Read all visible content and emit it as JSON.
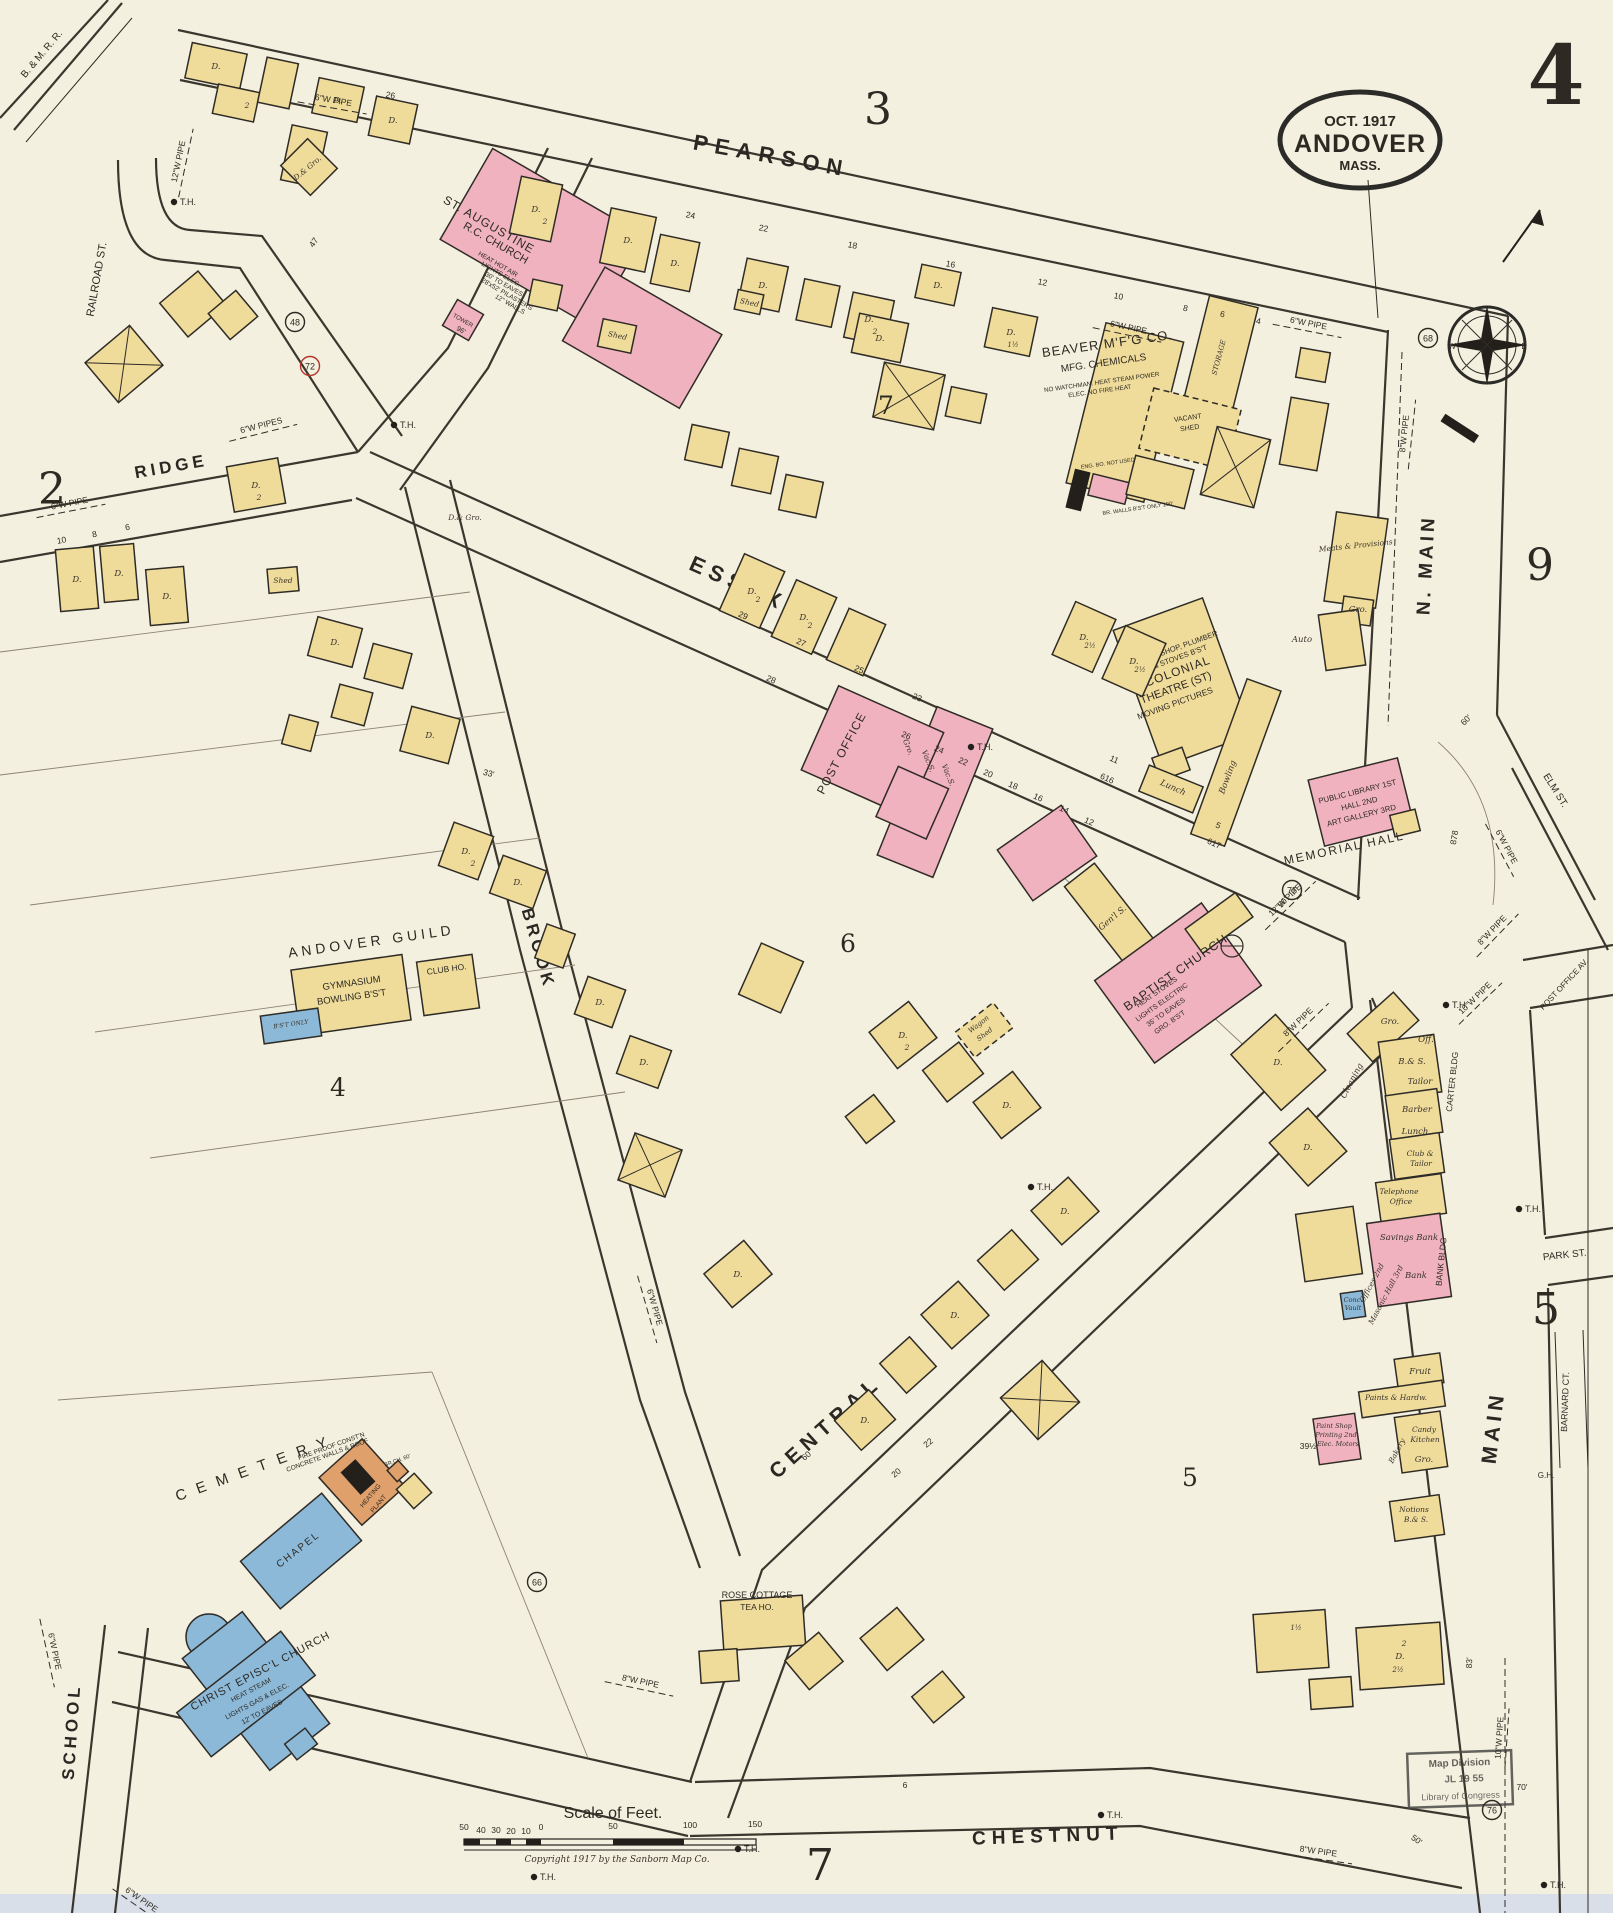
{
  "sheet": {
    "number": "4"
  },
  "stamp": {
    "date": "OCT. 1917",
    "city": "ANDOVER",
    "state": "MASS."
  },
  "adjacent": {
    "top": "3",
    "left": "2",
    "right": "9",
    "right_mid": "5",
    "bottom": "7"
  },
  "blocks": {
    "b7": "7",
    "b6": "6",
    "b4": "4",
    "b5": "5"
  },
  "streets": {
    "pearson": "PEARSON",
    "essex": "ESSEX",
    "ridge": "RIDGE",
    "brook": "BROOK",
    "central": "CENTRAL",
    "chestnut": "CHESTNUT",
    "school": "SCHOOL",
    "n_main": "N. MAIN",
    "main": "MAIN",
    "railroad": "RAILROAD ST.",
    "elm": "ELM ST.",
    "park": "PARK ST.",
    "barnard": "BARNARD CT.",
    "post_office_av": "POST OFFICE AV.",
    "bmrr": "B. & M. R. R."
  },
  "bld": {
    "st_aug": {
      "l1": "ST. AUGUSTINE",
      "l2": "R.C. CHURCH",
      "l3": "HEAT HOT AIR",
      "l4": "LIGHTS ELEC.",
      "l5": "30' TO EAVES",
      "l6": "28'x52' PILASTERS",
      "l7": "12\" WALLS",
      "tower": "TOWER",
      "tower_h": "96'"
    },
    "beaver": {
      "l1": "BEAVER M'F'G CO.",
      "l2": "MFG. CHEMICALS",
      "l3": "NO WATCHMAN. HEAT STEAM POWER",
      "l4": "ELEC. NO FIRE HEAT",
      "storage": "STORAGE",
      "vac1": "VACANT",
      "vac2": "SHED",
      "eng": "ENG. BO. NOT USED",
      "br": "BR. WALLS B'S'T ONLY 100'"
    },
    "colonial": {
      "l1": "TIN SHOP, PLUMBER",
      "l2": "& STOVES B'S'T",
      "l3": "COLONIAL",
      "l4": "THEATRE (ST)",
      "l5": "MOVING PICTURES"
    },
    "po": {
      "label": "POST OFFICE"
    },
    "lib": {
      "l1": "PUBLIC LIBRARY 1ST",
      "l2": "HALL 2ND",
      "l3": "ART GALLERY 3RD",
      "hall": "MEMORIAL HALL"
    },
    "baptist": {
      "l1": "BAPTIST CHURCH",
      "l2": "HEAT STOVES",
      "l3": "LIGHTS ELECTRIC",
      "l4": "35' TO EAVES",
      "l5": "GRO. B'S'T"
    },
    "guild": {
      "title": "ANDOVER GUILD",
      "l1": "GYMNASIUM",
      "l2": "BOWLING B'S'T",
      "club": "CLUB HO.",
      "bst": "B'S'T ONLY"
    },
    "christ": {
      "l1": "CHRIST EPISC'L CHURCH",
      "l2": "HEAT STEAM",
      "l3": "LIGHTS GAS & ELEC.",
      "l4": "12' TO EAVES",
      "chapel": "CHAPEL"
    },
    "heat": {
      "l1": "FIRE PROOF CONST'N",
      "l2": "CONCRETE WALLS & ROOF",
      "l3": "HEATING",
      "l4": "PLANT"
    },
    "rose": {
      "l1": "ROSE COTTAGE",
      "l2": "TEA HO."
    }
  },
  "areas": {
    "cemetery": "CEMETERY"
  },
  "compass": {
    "w": "W",
    "e": "E"
  },
  "footer": {
    "scale_title": "Scale of Feet.",
    "copyright": "Copyright 1917 by the Sanborn Map Co."
  },
  "loc": {
    "l1": "Map Division",
    "l2": "JL 19 55",
    "l3": "Library of Congress"
  },
  "scatter": [
    {
      "t": "6\"W PIPE",
      "x": 333,
      "y": 103,
      "r": 10,
      "d": 70
    },
    {
      "t": "12\"W PIPE",
      "x": 181,
      "y": 162,
      "r": -78,
      "d": 70
    },
    {
      "t": "6\"W PIPE",
      "x": 1128,
      "y": 330,
      "r": 12,
      "d": 70
    },
    {
      "t": "6\"W PIPE",
      "x": 1308,
      "y": 326,
      "r": 11,
      "d": 70
    },
    {
      "t": "8\"W PIPE",
      "x": 1407,
      "y": 434,
      "r": -84,
      "d": 70
    },
    {
      "t": "6\"W PIPES",
      "x": 262,
      "y": 428,
      "r": -14,
      "d": 70
    },
    {
      "t": "6\"W PIPE",
      "x": 70,
      "y": 506,
      "r": -11,
      "d": 70
    },
    {
      "t": "6\"W PIPE",
      "x": 1504,
      "y": 848,
      "r": 62,
      "d": 60
    },
    {
      "t": "8\"W PIPE",
      "x": 1494,
      "y": 932,
      "r": -46,
      "d": 60
    },
    {
      "t": "10\"W PIPE",
      "x": 1477,
      "y": 1000,
      "r": -44,
      "d": 60
    },
    {
      "t": "8\"W PIPE",
      "x": 1300,
      "y": 1024,
      "r": -44,
      "d": 70
    },
    {
      "t": "12\"W PIPE",
      "x": 1287,
      "y": 902,
      "r": -44,
      "d": 70
    },
    {
      "t": "6\"W PIPE",
      "x": 652,
      "y": 1308,
      "r": 74,
      "d": 70
    },
    {
      "t": "8\"W PIPE",
      "x": 640,
      "y": 1684,
      "r": 12,
      "d": 70
    },
    {
      "t": "6\"W PIPE",
      "x": 52,
      "y": 1652,
      "r": 78,
      "d": 70
    },
    {
      "t": "6\"W PIPE",
      "x": 140,
      "y": 1902,
      "r": 35,
      "d": 60
    },
    {
      "t": "8\"W PIPE",
      "x": 1318,
      "y": 1854,
      "r": 8,
      "d": 70
    },
    {
      "t": "10\"W PIPE",
      "x": 1502,
      "y": 1738,
      "r": -86,
      "d": 60
    },
    {
      "k": "th",
      "t": "T.H.",
      "x": 188,
      "y": 205
    },
    {
      "k": "th",
      "t": "T.H.",
      "x": 408,
      "y": 428
    },
    {
      "k": "th",
      "t": "T.H.",
      "x": 985,
      "y": 750
    },
    {
      "k": "th",
      "t": "T.H.",
      "x": 1460,
      "y": 1008
    },
    {
      "k": "th",
      "t": "T.H.",
      "x": 1045,
      "y": 1190
    },
    {
      "k": "th",
      "t": "T.H.",
      "x": 1533,
      "y": 1212
    },
    {
      "k": "th",
      "t": "T.H.",
      "x": 548,
      "y": 1880
    },
    {
      "k": "th",
      "t": "T.H.",
      "x": 752,
      "y": 1852
    },
    {
      "k": "th",
      "t": "T.H.",
      "x": 1115,
      "y": 1818
    },
    {
      "k": "th",
      "t": "T.H.",
      "x": 1558,
      "y": 1888
    },
    {
      "t": "G.H.",
      "x": 1546,
      "y": 1478,
      "s": 8
    },
    {
      "k": "c",
      "t": "48",
      "x": 295,
      "y": 322
    },
    {
      "k": "rc",
      "t": "72",
      "x": 310,
      "y": 366
    },
    {
      "k": "c",
      "t": "68",
      "x": 1428,
      "y": 338
    },
    {
      "k": "c",
      "t": "66",
      "x": 537,
      "y": 1582
    },
    {
      "k": "c",
      "t": "75",
      "x": 1292,
      "y": 890
    },
    {
      "k": "c",
      "t": "76",
      "x": 1492,
      "y": 1810
    },
    {
      "t": "24",
      "x": 690,
      "y": 218,
      "r": 11
    },
    {
      "t": "22",
      "x": 763,
      "y": 231,
      "r": 11
    },
    {
      "t": "18",
      "x": 852,
      "y": 248,
      "r": 11
    },
    {
      "t": "16",
      "x": 950,
      "y": 267,
      "r": 11
    },
    {
      "t": "12",
      "x": 1042,
      "y": 285,
      "r": 11
    },
    {
      "t": "10",
      "x": 1118,
      "y": 299,
      "r": 11
    },
    {
      "t": "8",
      "x": 1185,
      "y": 311,
      "r": 11
    },
    {
      "t": "6",
      "x": 1222,
      "y": 317,
      "r": 11
    },
    {
      "t": "4",
      "x": 1258,
      "y": 324,
      "r": 11
    },
    {
      "t": "26",
      "x": 390,
      "y": 98,
      "r": 10
    },
    {
      "t": "29",
      "x": 742,
      "y": 618,
      "r": 24
    },
    {
      "t": "27",
      "x": 800,
      "y": 645,
      "r": 24
    },
    {
      "t": "25",
      "x": 858,
      "y": 672,
      "r": 24
    },
    {
      "t": "23",
      "x": 916,
      "y": 700,
      "r": 24
    },
    {
      "t": "28",
      "x": 770,
      "y": 682,
      "r": 24
    },
    {
      "t": "26",
      "x": 905,
      "y": 738,
      "r": 24
    },
    {
      "t": "24",
      "x": 938,
      "y": 752,
      "r": 24
    },
    {
      "t": "22",
      "x": 962,
      "y": 764,
      "r": 24
    },
    {
      "t": "20",
      "x": 987,
      "y": 776,
      "r": 24
    },
    {
      "t": "18",
      "x": 1012,
      "y": 788,
      "r": 24
    },
    {
      "t": "16",
      "x": 1037,
      "y": 800,
      "r": 24
    },
    {
      "t": "14",
      "x": 1063,
      "y": 812,
      "r": 24
    },
    {
      "t": "12",
      "x": 1088,
      "y": 824,
      "r": 24
    },
    {
      "t": "11",
      "x": 1113,
      "y": 762,
      "r": 24
    },
    {
      "t": "616",
      "x": 1106,
      "y": 781,
      "r": 24
    },
    {
      "t": "5",
      "x": 1217,
      "y": 828,
      "r": 24
    },
    {
      "t": "617",
      "x": 1213,
      "y": 846,
      "r": 24
    },
    {
      "t": "60'",
      "x": 1468,
      "y": 722,
      "r": -45
    },
    {
      "t": "50'",
      "x": 1285,
      "y": 904,
      "r": -50
    },
    {
      "t": "878",
      "x": 1457,
      "y": 838,
      "r": -80
    },
    {
      "t": "83'",
      "x": 1472,
      "y": 1663,
      "r": -87
    },
    {
      "t": "70'",
      "x": 1522,
      "y": 1790
    },
    {
      "t": "39½",
      "x": 1308,
      "y": 1449
    },
    {
      "t": "33'",
      "x": 488,
      "y": 776,
      "r": 15
    },
    {
      "t": "60",
      "x": 808,
      "y": 1458,
      "r": -40
    },
    {
      "t": "22",
      "x": 930,
      "y": 1445,
      "r": -40
    },
    {
      "t": "20",
      "x": 898,
      "y": 1475,
      "r": -40
    },
    {
      "t": "6",
      "x": 905,
      "y": 1788
    },
    {
      "t": "47",
      "x": 316,
      "y": 244,
      "r": -55
    },
    {
      "t": "50'",
      "x": 1415,
      "y": 1842,
      "r": 35
    },
    {
      "t": "10",
      "x": 62,
      "y": 543,
      "r": -10
    },
    {
      "t": "8",
      "x": 95,
      "y": 537,
      "r": -10
    },
    {
      "t": "6",
      "x": 128,
      "y": 530,
      "r": -10
    },
    {
      "t": "BR.CH. 60'",
      "x": 398,
      "y": 1462,
      "r": -20,
      "s": 5.5
    },
    {
      "t": "Gro.",
      "x": 1390,
      "y": 1024,
      "i": 1
    },
    {
      "t": "Off.",
      "x": 1426,
      "y": 1042,
      "i": 1
    },
    {
      "t": "B.& S.",
      "x": 1412,
      "y": 1064,
      "i": 1
    },
    {
      "t": "Tailor",
      "x": 1420,
      "y": 1084,
      "i": 1
    },
    {
      "t": "Cleaning",
      "x": 1354,
      "y": 1082,
      "i": 1,
      "r": -62
    },
    {
      "t": "Barber",
      "x": 1417,
      "y": 1112,
      "i": 1
    },
    {
      "t": "Lunch",
      "x": 1415,
      "y": 1134,
      "i": 1
    },
    {
      "t": "Club &",
      "x": 1420,
      "y": 1156,
      "i": 1,
      "s": 7.5
    },
    {
      "t": "Tailor",
      "x": 1421,
      "y": 1166,
      "i": 1,
      "s": 7.5
    },
    {
      "t": "Telephone",
      "x": 1399,
      "y": 1194,
      "i": 1,
      "s": 7.5
    },
    {
      "t": "Office",
      "x": 1401,
      "y": 1204,
      "i": 1,
      "s": 7.5
    },
    {
      "t": "Savings Bank",
      "x": 1409,
      "y": 1240,
      "i": 1
    },
    {
      "t": "Bank",
      "x": 1416,
      "y": 1278,
      "i": 1
    },
    {
      "t": "Offices 2nd",
      "x": 1374,
      "y": 1284,
      "i": 1,
      "r": -62,
      "s": 7.5
    },
    {
      "t": "Masonic Hall 3rd",
      "x": 1388,
      "y": 1296,
      "i": 1,
      "r": -62,
      "s": 7.5
    },
    {
      "t": "BANK BLDG",
      "x": 1444,
      "y": 1262,
      "r": -84,
      "s": 8.5
    },
    {
      "t": "CARTER BLDG",
      "x": 1455,
      "y": 1082,
      "r": -84,
      "s": 8.5
    },
    {
      "t": "Conc.",
      "x": 1353,
      "y": 1302,
      "i": 1,
      "s": 6.5
    },
    {
      "t": "Vault",
      "x": 1353,
      "y": 1310,
      "i": 1,
      "s": 6.5
    },
    {
      "t": "Fruit",
      "x": 1420,
      "y": 1374,
      "i": 1
    },
    {
      "t": "Paints & Hardw.",
      "x": 1396,
      "y": 1400,
      "i": 1,
      "s": 7.5
    },
    {
      "t": "Candy",
      "x": 1424,
      "y": 1432,
      "i": 1,
      "s": 7.5
    },
    {
      "t": "Kitchen",
      "x": 1425,
      "y": 1442,
      "i": 1,
      "s": 7.5
    },
    {
      "t": "Gro.",
      "x": 1424,
      "y": 1462,
      "i": 1
    },
    {
      "t": "Bakery",
      "x": 1399,
      "y": 1452,
      "i": 1,
      "r": -62,
      "s": 7.5
    },
    {
      "t": "Paint Shop",
      "x": 1334,
      "y": 1428,
      "i": 1,
      "s": 6.5
    },
    {
      "t": "Printing 2nd",
      "x": 1336,
      "y": 1437,
      "i": 1,
      "s": 6.5
    },
    {
      "t": "Elec. Motors",
      "x": 1338,
      "y": 1446,
      "i": 1,
      "s": 6.5
    },
    {
      "t": "Notions",
      "x": 1414,
      "y": 1512,
      "i": 1,
      "s": 7.5
    },
    {
      "t": "B.& S.",
      "x": 1416,
      "y": 1522,
      "i": 1,
      "s": 7.5
    },
    {
      "t": "Auto",
      "x": 1302,
      "y": 642,
      "i": 1
    },
    {
      "t": "Lunch",
      "x": 1172,
      "y": 790,
      "r": 24,
      "i": 1
    },
    {
      "t": "Bowling",
      "x": 1230,
      "y": 778,
      "r": -70,
      "i": 1
    },
    {
      "t": "Meats & Provisions",
      "x": 1356,
      "y": 548,
      "i": 1,
      "r": -6,
      "s": 7.5
    },
    {
      "t": "Gro.",
      "x": 1358,
      "y": 612,
      "i": 1
    },
    {
      "t": "Gen'l S.",
      "x": 1114,
      "y": 920,
      "i": 1,
      "r": -40
    },
    {
      "t": "Gro.",
      "x": 906,
      "y": 748,
      "r": 68,
      "i": 1,
      "s": 7.5
    },
    {
      "t": "Vac.S.",
      "x": 926,
      "y": 762,
      "r": 68,
      "i": 1,
      "s": 7.5
    },
    {
      "t": "Vac.S.",
      "x": 946,
      "y": 776,
      "r": 68,
      "i": 1,
      "s": 7.5
    },
    {
      "t": "Wagon",
      "x": 980,
      "y": 1026,
      "r": -38,
      "i": 1,
      "s": 7
    },
    {
      "t": "Shed",
      "x": 986,
      "y": 1036,
      "r": -38,
      "i": 1,
      "s": 7
    },
    {
      "t": "Shed",
      "x": 749,
      "y": 305,
      "i": 1,
      "s": 7.5,
      "r": 12
    },
    {
      "t": "Shed",
      "x": 283,
      "y": 583,
      "i": 1,
      "s": 7.5
    },
    {
      "t": "Shed",
      "x": 617,
      "y": 338,
      "i": 1,
      "s": 7.5,
      "r": 12
    },
    {
      "t": "D.& Gro.",
      "x": 309,
      "y": 170,
      "r": -40,
      "i": 1,
      "s": 7.5
    },
    {
      "t": "D.& Gro.",
      "x": 465,
      "y": 520,
      "i": 1,
      "s": 7.5
    },
    {
      "t": "D.",
      "x": 216,
      "y": 69,
      "i": 1
    },
    {
      "t": "D.",
      "x": 338,
      "y": 103,
      "i": 1
    },
    {
      "t": "D.",
      "x": 393,
      "y": 123,
      "i": 1
    },
    {
      "t": "D.",
      "x": 536,
      "y": 212,
      "i": 1
    },
    {
      "t": "D.",
      "x": 628,
      "y": 243,
      "i": 1
    },
    {
      "t": "D.",
      "x": 675,
      "y": 266,
      "i": 1
    },
    {
      "t": "D.",
      "x": 763,
      "y": 288,
      "i": 1
    },
    {
      "t": "D.",
      "x": 869,
      "y": 322,
      "i": 1
    },
    {
      "t": "D.",
      "x": 1011,
      "y": 335,
      "i": 1
    },
    {
      "t": "D.",
      "x": 752,
      "y": 594,
      "i": 1
    },
    {
      "t": "D.",
      "x": 804,
      "y": 620,
      "i": 1
    },
    {
      "t": "D.",
      "x": 256,
      "y": 488,
      "i": 1
    },
    {
      "t": "D.",
      "x": 119,
      "y": 576,
      "i": 1
    },
    {
      "t": "D.",
      "x": 77,
      "y": 582,
      "i": 1
    },
    {
      "t": "D.",
      "x": 167,
      "y": 599,
      "i": 1
    },
    {
      "t": "D.",
      "x": 335,
      "y": 645,
      "i": 1
    },
    {
      "t": "D.",
      "x": 430,
      "y": 738,
      "i": 1
    },
    {
      "t": "D.",
      "x": 466,
      "y": 854,
      "i": 1
    },
    {
      "t": "D.",
      "x": 518,
      "y": 885,
      "i": 1
    },
    {
      "t": "D.",
      "x": 600,
      "y": 1005,
      "i": 1
    },
    {
      "t": "D.",
      "x": 644,
      "y": 1065,
      "i": 1
    },
    {
      "t": "D.",
      "x": 738,
      "y": 1277,
      "i": 1
    },
    {
      "t": "D.",
      "x": 903,
      "y": 1038,
      "i": 1
    },
    {
      "t": "D.",
      "x": 1007,
      "y": 1108,
      "i": 1
    },
    {
      "t": "D.",
      "x": 1065,
      "y": 1214,
      "i": 1
    },
    {
      "t": "D.",
      "x": 955,
      "y": 1318,
      "i": 1
    },
    {
      "t": "D.",
      "x": 865,
      "y": 1423,
      "i": 1
    },
    {
      "t": "D.",
      "x": 1278,
      "y": 1065,
      "i": 1
    },
    {
      "t": "D.",
      "x": 1308,
      "y": 1150,
      "i": 1
    },
    {
      "t": "D.",
      "x": 1400,
      "y": 1659,
      "i": 1
    },
    {
      "t": "D.",
      "x": 1084,
      "y": 640,
      "i": 1
    },
    {
      "t": "D.",
      "x": 1134,
      "y": 664,
      "i": 1
    },
    {
      "t": "D.",
      "x": 880,
      "y": 341,
      "i": 1
    },
    {
      "t": "D.",
      "x": 938,
      "y": 288,
      "i": 1
    },
    {
      "t": "2",
      "x": 247,
      "y": 108,
      "i": 1,
      "s": 7.5
    },
    {
      "t": "2",
      "x": 545,
      "y": 224,
      "i": 1,
      "s": 7.5
    },
    {
      "t": "2",
      "x": 875,
      "y": 334,
      "i": 1,
      "s": 7.5
    },
    {
      "t": "2",
      "x": 758,
      "y": 602,
      "i": 1,
      "s": 7.5
    },
    {
      "t": "2",
      "x": 810,
      "y": 628,
      "i": 1,
      "s": 7.5
    },
    {
      "t": "2",
      "x": 259,
      "y": 500,
      "i": 1,
      "s": 7.5
    },
    {
      "t": "2",
      "x": 473,
      "y": 866,
      "i": 1,
      "s": 7.5
    },
    {
      "t": "2",
      "x": 907,
      "y": 1050,
      "i": 1,
      "s": 7.5
    },
    {
      "t": "2",
      "x": 1404,
      "y": 1646,
      "i": 1,
      "s": 7.5
    },
    {
      "t": "1½",
      "x": 1013,
      "y": 347,
      "i": 1,
      "s": 7
    },
    {
      "t": "1½",
      "x": 1296,
      "y": 1630,
      "i": 1,
      "s": 7
    },
    {
      "t": "2½",
      "x": 1090,
      "y": 648,
      "i": 1,
      "s": 7
    },
    {
      "t": "2½",
      "x": 1140,
      "y": 672,
      "i": 1,
      "s": 7
    },
    {
      "t": "2½",
      "x": 1398,
      "y": 1672,
      "i": 1,
      "s": 7
    },
    {
      "t": "50",
      "x": 464,
      "y": 1830,
      "s": 8.5
    },
    {
      "t": "40",
      "x": 481,
      "y": 1833,
      "s": 8.5
    },
    {
      "t": "30",
      "x": 496,
      "y": 1833,
      "s": 8.5
    },
    {
      "t": "20",
      "x": 511,
      "y": 1834,
      "s": 8.5
    },
    {
      "t": "10",
      "x": 526,
      "y": 1834,
      "s": 8.5
    },
    {
      "t": "0",
      "x": 541,
      "y": 1830,
      "s": 8.5
    },
    {
      "t": "50",
      "x": 613,
      "y": 1829,
      "s": 8.5
    },
    {
      "t": "100",
      "x": 690,
      "y": 1828,
      "s": 8.5
    },
    {
      "t": "150",
      "x": 755,
      "y": 1827,
      "s": 8.5
    }
  ]
}
